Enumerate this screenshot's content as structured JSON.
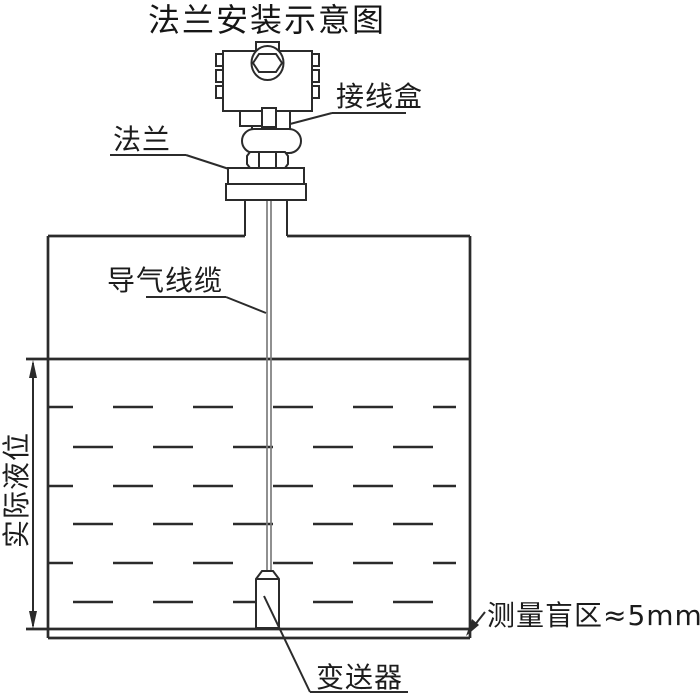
{
  "title": "法兰安装示意图",
  "labels": {
    "junction_box": "接线盒",
    "flange": "法兰",
    "air_cable": "导气线缆",
    "actual_level": "实际液位",
    "transmitter": "变送器",
    "blind_zone": "测量盲区≈5mm"
  },
  "colors": {
    "background": "#ffffff",
    "line": "#2b2b2b",
    "cable_line": "#7c7c7c",
    "text": "#1c1c1c"
  }
}
